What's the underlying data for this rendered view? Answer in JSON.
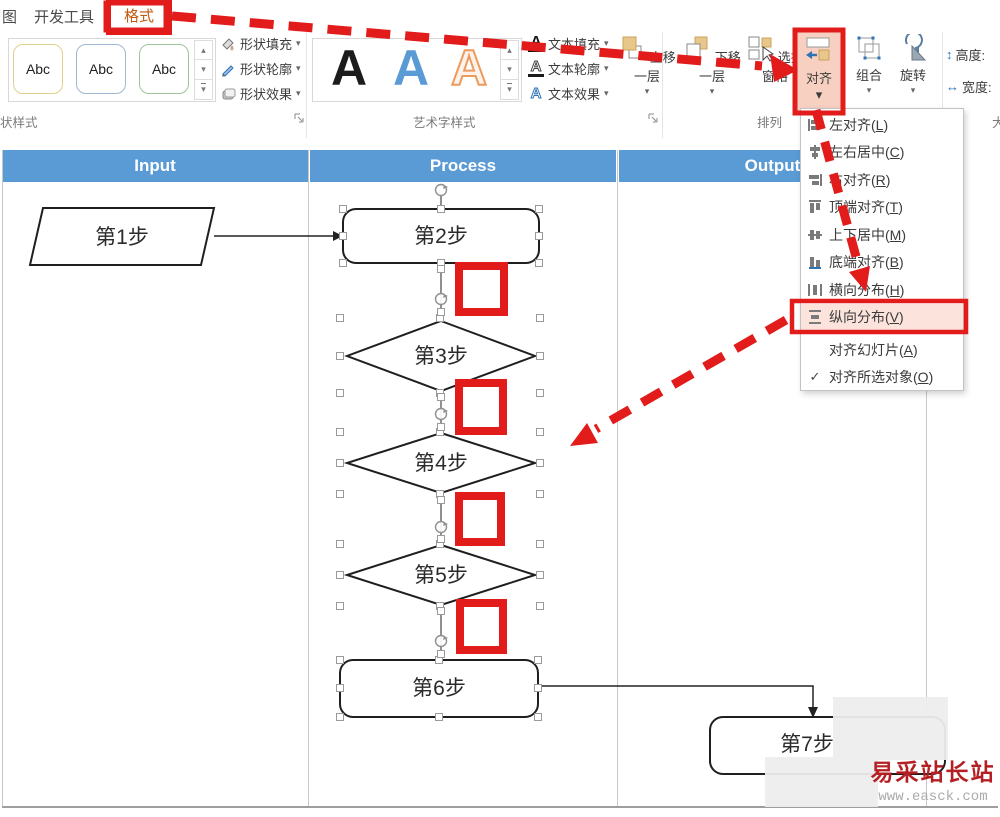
{
  "tabs": {
    "partial_left": "图",
    "developer": "开发工具",
    "format": "格式"
  },
  "ribbon": {
    "shape_styles": {
      "label": "状样式",
      "thumb": "Abc",
      "fill": "形状填充",
      "outline": "形状轮廓",
      "effects": "形状效果"
    },
    "wordart": {
      "label": "艺术字样式",
      "letter": "A",
      "text_fill": "文本填充",
      "text_outline": "文本轮廓",
      "text_effects": "文本效果"
    },
    "arrange": {
      "label": "排列",
      "bring_forward": "上移一层",
      "send_backward": "下移一层",
      "selection_pane": "选择窗格",
      "align": "对齐",
      "group": "组合",
      "rotate": "旋转"
    },
    "size": {
      "height": "高度:",
      "width": "宽度:",
      "partial": "大"
    }
  },
  "icons": {
    "dropdown_arrow": "▾",
    "gallery_up": "▴",
    "gallery_down": "▾",
    "gallery_more": "▾",
    "checkmark": "✓",
    "height_arrow": "↕",
    "width_arrow": "↔"
  },
  "align_menu": {
    "items": [
      {
        "pre": "左对齐(",
        "key": "L",
        "post": ")"
      },
      {
        "pre": "左右居中(",
        "key": "C",
        "post": ")"
      },
      {
        "pre": "右对齐(",
        "key": "R",
        "post": ")"
      },
      {
        "pre": "顶端对齐(",
        "key": "T",
        "post": ")"
      },
      {
        "pre": "上下居中(",
        "key": "M",
        "post": ")"
      },
      {
        "pre": "底端对齐(",
        "key": "B",
        "post": ")"
      },
      {
        "pre": "横向分布(",
        "key": "H",
        "post": ")"
      },
      {
        "pre": "纵向分布(",
        "key": "V",
        "post": ")"
      },
      {
        "pre": "对齐幻灯片(",
        "key": "A",
        "post": ")"
      },
      {
        "pre": "对齐所选对象(",
        "key": "O",
        "post": ")"
      }
    ]
  },
  "lanes": {
    "input": "Input",
    "process": "Process",
    "output": "Output"
  },
  "flowchart": {
    "step1": "第1步",
    "step2": "第2步",
    "step3": "第3步",
    "step4": "第4步",
    "step5": "第5步",
    "step6": "第6步",
    "step7": "第7步"
  },
  "watermark": {
    "title": "易采站长站",
    "url": "www.easck.com"
  },
  "colors": {
    "annotation": "#E21B1B",
    "lane_header": "#5B9BD5",
    "align_highlight": "#F7D0C2",
    "watermark": "#B51F24",
    "accent_blue": "#2E74B5",
    "tan": "#E9C78A"
  }
}
